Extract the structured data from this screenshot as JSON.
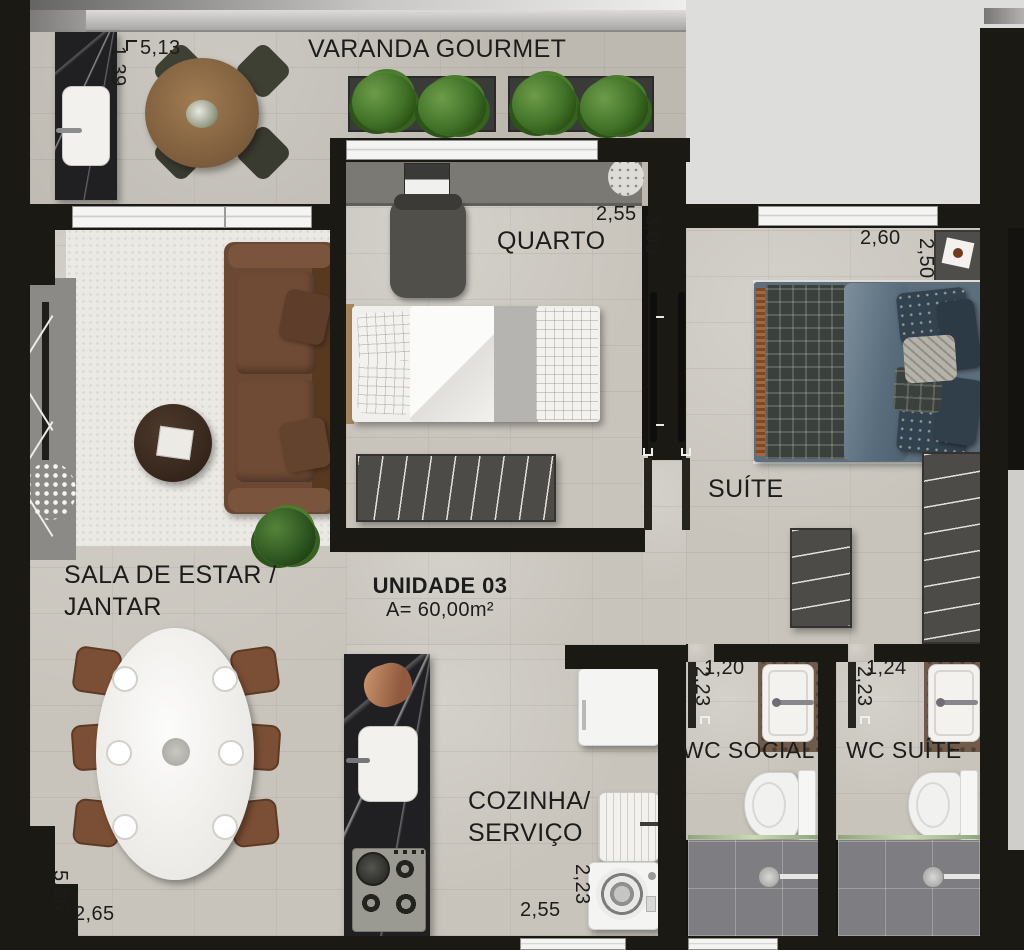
{
  "unit": {
    "name": "UNIDADE 03",
    "area": "A= 60,00m²"
  },
  "labels": {
    "varanda": "VARANDA GOURMET",
    "quarto": "QUARTO",
    "suite": "SUÍTE",
    "sala_line1": "SALA DE ESTAR /",
    "sala_line2": "JANTAR",
    "cozinha_line1": "COZINHA/",
    "cozinha_line2": "SERVIÇO",
    "wc_social": "WC SOCIAL",
    "wc_suite": "WC SUÍTE"
  },
  "dims": {
    "varanda_w": "5,13",
    "varanda_d": "1,39",
    "quarto_w": "2,55",
    "quarto_d": "3,03",
    "suite_w": "2,60",
    "suite_d": "2,50",
    "sala_w": "2,65",
    "sala_d": "5,85",
    "cozinha_w": "2,55",
    "cozinha_d": "2,23",
    "wc_social_w": "1,20",
    "wc_social_d": "2,23",
    "wc_suite_w": "1,24",
    "wc_suite_d": "2,23"
  },
  "colors": {
    "wall": "#1b1914",
    "floor_travertine": "#c8c4bc",
    "exterior": "#dddddb",
    "rug": "#ebe9e4",
    "sofa_leather": "#6b4833",
    "bed_blue": "#5d6e7d",
    "plant_green": "#3f7026",
    "marble_counter": "#202023",
    "shower_tile": "#7e7d81",
    "wood_table": "#8a6a4e"
  }
}
